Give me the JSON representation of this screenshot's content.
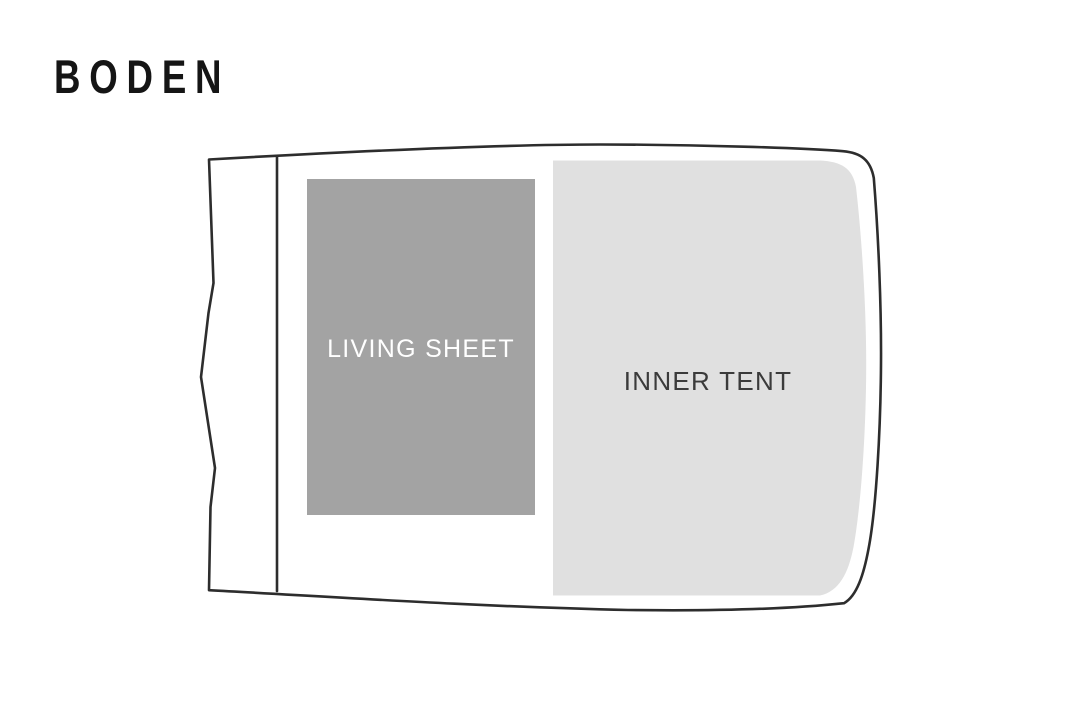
{
  "title": {
    "text": "BODEN",
    "color": "#151515"
  },
  "diagram": {
    "background": "#ffffff",
    "outline_color": "#2d2d2d",
    "areas": {
      "living_sheet": {
        "label": "LIVING SHEET",
        "fill": "#a3a3a3",
        "label_color": "#ffffff"
      },
      "inner_tent": {
        "label": "INNER TENT",
        "fill": "#e0e0e0",
        "label_color": "#3b3b3b"
      }
    }
  }
}
